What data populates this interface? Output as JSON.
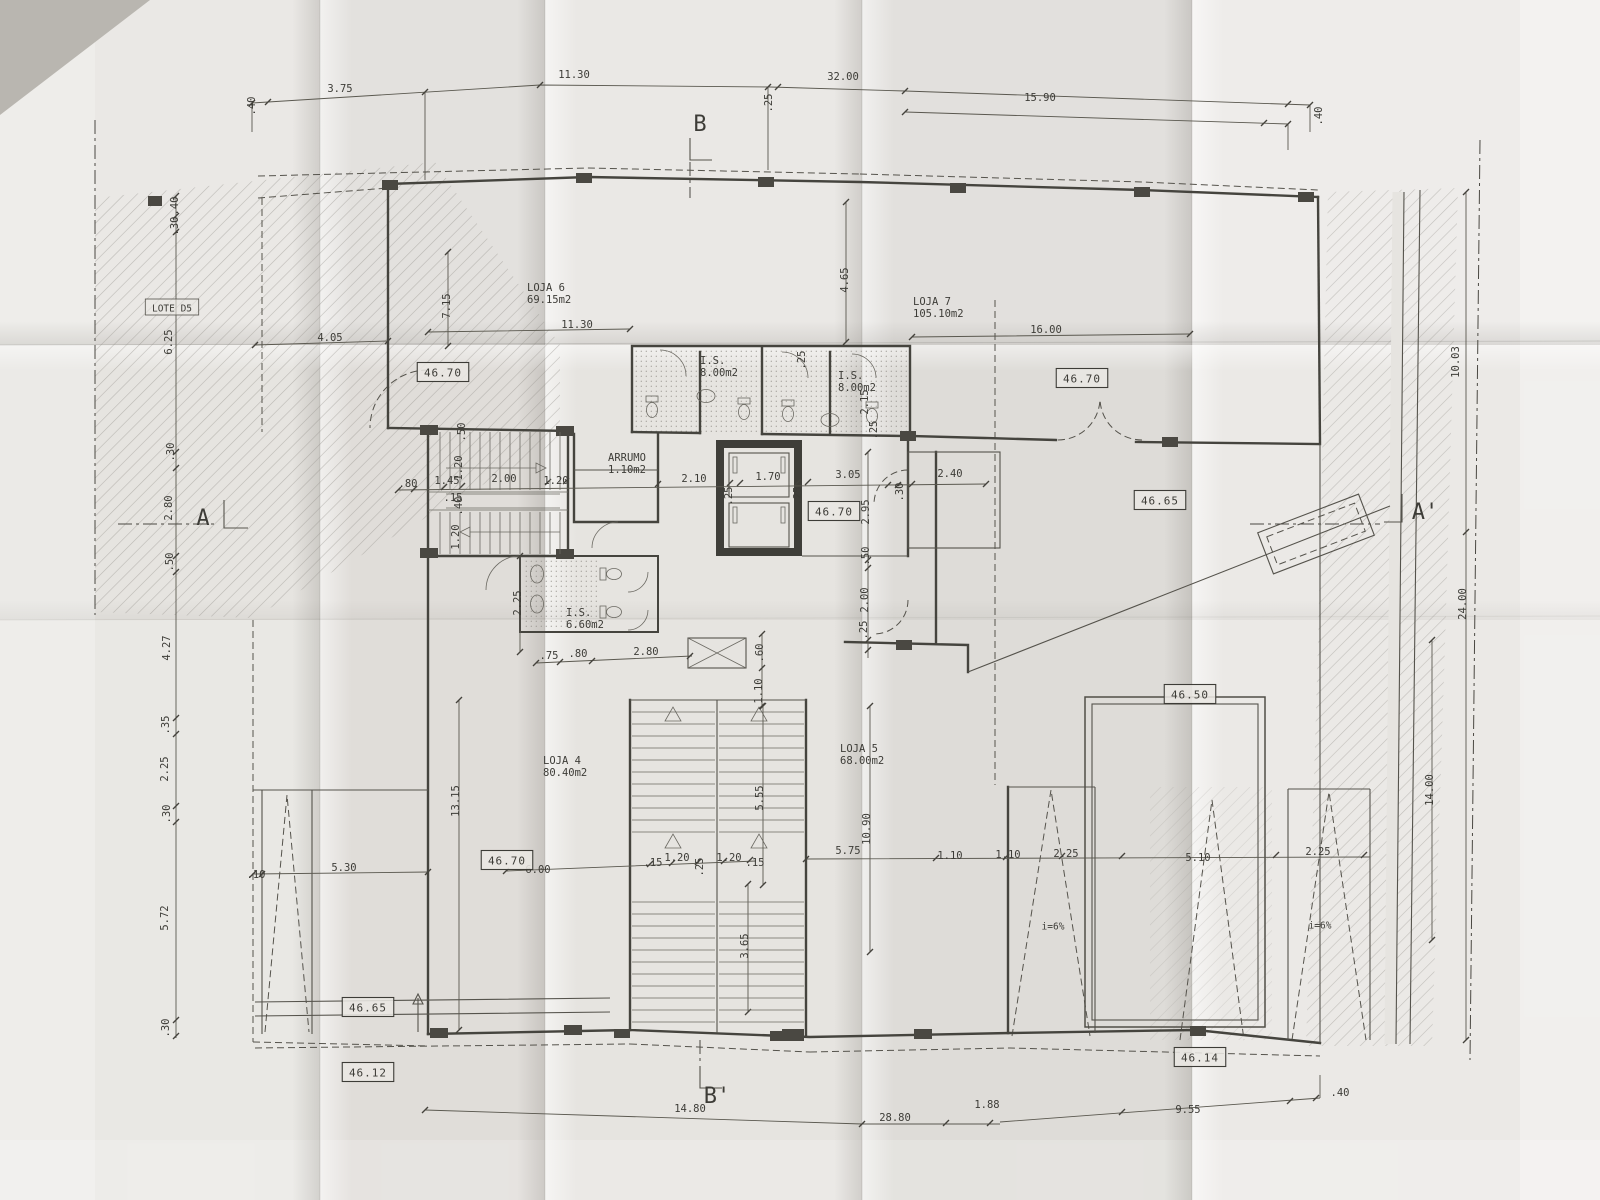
{
  "drawing": {
    "type": "architectural-floor-plan-photo",
    "section_markers": [
      {
        "t": "B",
        "x": 700,
        "y": 131
      },
      {
        "t": "B'",
        "x": 717,
        "y": 1103
      },
      {
        "t": "A",
        "x": 203,
        "y": 525
      },
      {
        "t": "A'",
        "x": 1425,
        "y": 519
      }
    ],
    "rooms": [
      {
        "name": "LOJA 6",
        "area": "69.15m2",
        "x": 527,
        "y": 291
      },
      {
        "name": "LOJA 7",
        "area": "105.10m2",
        "x": 913,
        "y": 305
      },
      {
        "name": "LOJA 4",
        "area": "80.40m2",
        "x": 543,
        "y": 764
      },
      {
        "name": "LOJA 5",
        "area": "68.00m2",
        "x": 840,
        "y": 752
      },
      {
        "name": "I.S.",
        "area": "8.00m2",
        "x": 700,
        "y": 364
      },
      {
        "name": "I.S.",
        "area": "8.00m2",
        "x": 838,
        "y": 379
      },
      {
        "name": "I.S.",
        "area": "6.60m2",
        "x": 566,
        "y": 616
      },
      {
        "name": "ARRUMO",
        "area": "1.10m2",
        "x": 608,
        "y": 461
      }
    ],
    "levels": [
      {
        "v": "46.70",
        "x": 443,
        "y": 372
      },
      {
        "v": "46.70",
        "x": 1082,
        "y": 378
      },
      {
        "v": "46.70",
        "x": 834,
        "y": 511
      },
      {
        "v": "46.65",
        "x": 1160,
        "y": 500
      },
      {
        "v": "46.50",
        "x": 1190,
        "y": 694
      },
      {
        "v": "46.70",
        "x": 507,
        "y": 860
      },
      {
        "v": "46.65",
        "x": 368,
        "y": 1007
      },
      {
        "v": "46.12",
        "x": 368,
        "y": 1072
      },
      {
        "v": "46.14",
        "x": 1200,
        "y": 1057
      }
    ],
    "notes": [
      {
        "t": "LOTE D5",
        "x": 172,
        "y": 308,
        "boxed": true
      },
      {
        "t": "i=6%",
        "x": 1053,
        "y": 926
      },
      {
        "t": "i=6%",
        "x": 1320,
        "y": 925
      }
    ],
    "dims": [
      {
        "t": ".40",
        "x": 255,
        "y": 106,
        "r": -90
      },
      {
        "t": "3.75",
        "x": 340,
        "y": 92
      },
      {
        "t": "11.30",
        "x": 574,
        "y": 78
      },
      {
        "t": "32.00",
        "x": 843,
        "y": 80
      },
      {
        "t": ".25",
        "x": 772,
        "y": 103,
        "r": -90
      },
      {
        "t": "15.90",
        "x": 1040,
        "y": 101
      },
      {
        "t": ".40",
        "x": 1322,
        "y": 116,
        "r": -90
      },
      {
        "t": ".40",
        "x": 178,
        "y": 206,
        "r": -90
      },
      {
        "t": ".30",
        "x": 178,
        "y": 226,
        "r": -90
      },
      {
        "t": "6.25",
        "x": 172,
        "y": 342,
        "r": -90
      },
      {
        "t": ".30",
        "x": 174,
        "y": 452,
        "r": -90
      },
      {
        "t": "2.80",
        "x": 172,
        "y": 508,
        "r": -90
      },
      {
        "t": ".50",
        "x": 173,
        "y": 562,
        "r": -90
      },
      {
        "t": "4.27",
        "x": 170,
        "y": 648,
        "r": -90
      },
      {
        "t": ".35",
        "x": 169,
        "y": 725,
        "r": -90
      },
      {
        "t": "2.25",
        "x": 168,
        "y": 769,
        "r": -90
      },
      {
        "t": ".30",
        "x": 170,
        "y": 814,
        "r": -90
      },
      {
        "t": "5.72",
        "x": 168,
        "y": 918,
        "r": -90
      },
      {
        "t": ".30",
        "x": 169,
        "y": 1028,
        "r": -90
      },
      {
        "t": "4.05",
        "x": 330,
        "y": 341
      },
      {
        "t": "7.15",
        "x": 450,
        "y": 306,
        "r": -90
      },
      {
        "t": "11.30",
        "x": 577,
        "y": 328
      },
      {
        "t": "16.00",
        "x": 1046,
        "y": 333
      },
      {
        "t": "4.65",
        "x": 848,
        "y": 280,
        "r": -90
      },
      {
        "t": ".25",
        "x": 805,
        "y": 360,
        "r": -90
      },
      {
        "t": "2.15",
        "x": 868,
        "y": 402,
        "r": -90
      },
      {
        "t": ".25",
        "x": 877,
        "y": 430,
        "r": -90
      },
      {
        "t": ".80",
        "x": 408,
        "y": 487
      },
      {
        "t": "1.45",
        "x": 447,
        "y": 484
      },
      {
        "t": ".15",
        "x": 453,
        "y": 501
      },
      {
        "t": "1.20",
        "x": 462,
        "y": 468,
        "r": -90
      },
      {
        "t": "2.00",
        "x": 504,
        "y": 482
      },
      {
        "t": "1.20",
        "x": 556,
        "y": 484
      },
      {
        "t": "2.10",
        "x": 694,
        "y": 482
      },
      {
        "t": ".25",
        "x": 732,
        "y": 496,
        "r": -90
      },
      {
        "t": "1.70",
        "x": 768,
        "y": 480
      },
      {
        "t": ".25",
        "x": 801,
        "y": 496,
        "r": -90
      },
      {
        "t": "3.05",
        "x": 848,
        "y": 478
      },
      {
        "t": ".30",
        "x": 903,
        "y": 492,
        "r": -90
      },
      {
        "t": "2.40",
        "x": 950,
        "y": 477
      },
      {
        "t": ".50",
        "x": 465,
        "y": 432,
        "r": -90
      },
      {
        "t": ".40",
        "x": 462,
        "y": 506,
        "r": -90
      },
      {
        "t": "1.20",
        "x": 459,
        "y": 537,
        "r": -90
      },
      {
        "t": "2.95",
        "x": 869,
        "y": 512,
        "r": -90
      },
      {
        "t": ".50",
        "x": 869,
        "y": 556,
        "r": -90
      },
      {
        "t": "2.00",
        "x": 868,
        "y": 600,
        "r": -90
      },
      {
        "t": ".25",
        "x": 867,
        "y": 630,
        "r": -90
      },
      {
        "t": "2.25",
        "x": 521,
        "y": 603,
        "r": -90
      },
      {
        "t": ".75",
        "x": 549,
        "y": 659
      },
      {
        "t": ".80",
        "x": 578,
        "y": 657
      },
      {
        "t": "2.80",
        "x": 646,
        "y": 655
      },
      {
        "t": ".60",
        "x": 763,
        "y": 653,
        "r": -90
      },
      {
        "t": "1.10",
        "x": 762,
        "y": 691,
        "r": -90
      },
      {
        "t": "13.15",
        "x": 459,
        "y": 801,
        "r": -90
      },
      {
        "t": "5.55",
        "x": 763,
        "y": 798,
        "r": -90
      },
      {
        "t": "10.90",
        "x": 870,
        "y": 829,
        "r": -90
      },
      {
        "t": "3.65",
        "x": 748,
        "y": 946,
        "r": -90
      },
      {
        "t": "6.00",
        "x": 538,
        "y": 873
      },
      {
        "t": ".15",
        "x": 653,
        "y": 866
      },
      {
        "t": "1.20",
        "x": 677,
        "y": 861
      },
      {
        "t": ".25",
        "x": 703,
        "y": 867,
        "r": -90
      },
      {
        "t": "1.20",
        "x": 729,
        "y": 861
      },
      {
        "t": ".15",
        "x": 755,
        "y": 866
      },
      {
        "t": "5.75",
        "x": 848,
        "y": 854
      },
      {
        "t": "1.10",
        "x": 950,
        "y": 859
      },
      {
        "t": "1.10",
        "x": 1008,
        "y": 858
      },
      {
        "t": "2.25",
        "x": 1066,
        "y": 857
      },
      {
        "t": "5.10",
        "x": 1198,
        "y": 861
      },
      {
        "t": "2.25",
        "x": 1318,
        "y": 855
      },
      {
        "t": ".10",
        "x": 256,
        "y": 878
      },
      {
        "t": "5.30",
        "x": 344,
        "y": 871
      },
      {
        "t": "14.80",
        "x": 690,
        "y": 1112
      },
      {
        "t": "28.80",
        "x": 895,
        "y": 1121
      },
      {
        "t": "1.88",
        "x": 987,
        "y": 1108
      },
      {
        "t": "9.55",
        "x": 1188,
        "y": 1113
      },
      {
        "t": ".40",
        "x": 1340,
        "y": 1096
      },
      {
        "t": "10.03",
        "x": 1459,
        "y": 362,
        "r": -90
      },
      {
        "t": "24.00",
        "x": 1466,
        "y": 604,
        "r": -90
      },
      {
        "t": "14.00",
        "x": 1433,
        "y": 790,
        "r": -90
      }
    ]
  },
  "colors": {
    "paper": "#e6e4e0",
    "paper_light": "#efede9",
    "corner_shadow": "#b9b6b0",
    "ink": "#45443e",
    "hatch": "#8d8a84"
  }
}
